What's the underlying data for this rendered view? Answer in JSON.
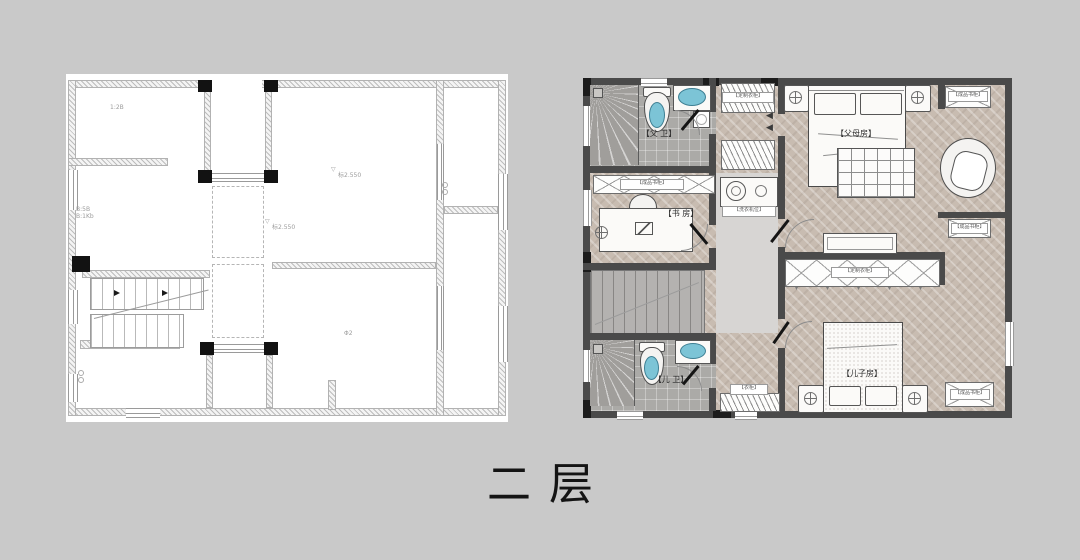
{
  "page": {
    "title": "二层",
    "background": "#c9c9c9"
  },
  "left_plan": {
    "elev_icon": "▽",
    "annotations": {
      "a1": "1:2B",
      "a2": "B:5B",
      "a3": "B:1Kb",
      "a4": "标2.550",
      "a5": "标2.550",
      "a6": "Φ2"
    }
  },
  "right_plan": {
    "rooms": {
      "parents_bath": "【父 卫】",
      "study": "【书 房】",
      "master": "【父母房】",
      "kids_bath": "【儿 卫】",
      "sons_room": "【儿子房】"
    },
    "cabinets": {
      "study_bookcase": "【成品书柜】",
      "wardrobe_top": "【定制衣柜】",
      "wardrobe_row": "【定制衣柜】",
      "laundry": "【洗衣机位】",
      "corner_tr": "【成品书柜】",
      "mid_right": "【成品书柜】",
      "corner_br": "【成品书柜】",
      "hall_cabinet": "【衣柜】"
    },
    "icons": {
      "door_left": "◀",
      "tick": "▾"
    },
    "colors": {
      "wall": "#4a4a4a",
      "wood_floor": "#c8bcb1",
      "tile_floor": "#abaaa7",
      "corridor_floor": "#d7d5d3",
      "fixture_blue": "#7cc4d6"
    }
  }
}
